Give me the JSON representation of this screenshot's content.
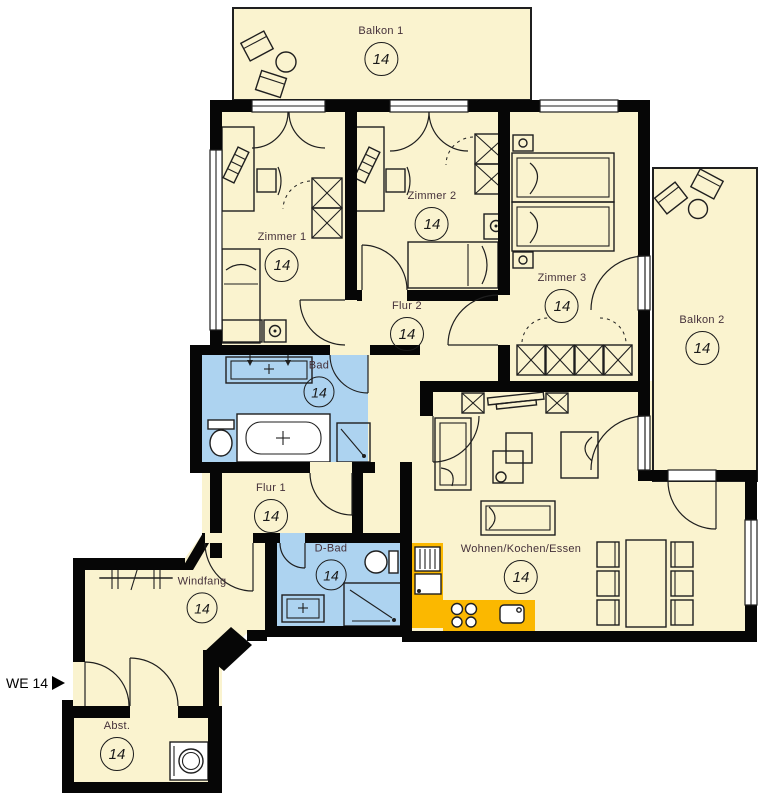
{
  "plan": {
    "unit_label": "WE 14",
    "colors": {
      "floor": "#FAF3CF",
      "wet": "#ADD3F0",
      "kitchen": "#FBB800",
      "wall": "#060606",
      "line": "#1f1f1f",
      "label": "#44303a"
    },
    "rooms": [
      {
        "id": "balkon1",
        "name": "Balkon 1",
        "number": "14"
      },
      {
        "id": "zimmer1",
        "name": "Zimmer 1",
        "number": "14"
      },
      {
        "id": "zimmer2",
        "name": "Zimmer 2",
        "number": "14"
      },
      {
        "id": "zimmer3",
        "name": "Zimmer 3",
        "number": "14"
      },
      {
        "id": "flur2",
        "name": "Flur 2",
        "number": "14"
      },
      {
        "id": "bad",
        "name": "Bad",
        "number": "14"
      },
      {
        "id": "flur1",
        "name": "Flur 1",
        "number": "14"
      },
      {
        "id": "dbad",
        "name": "D-Bad",
        "number": "14"
      },
      {
        "id": "windfang",
        "name": "Windfang",
        "number": "14"
      },
      {
        "id": "wohnen",
        "name": "Wohnen/Kochen/Essen",
        "number": "14"
      },
      {
        "id": "abst",
        "name": "Abst.",
        "number": "14"
      },
      {
        "id": "balkon2",
        "name": "Balkon 2",
        "number": "14"
      }
    ]
  }
}
